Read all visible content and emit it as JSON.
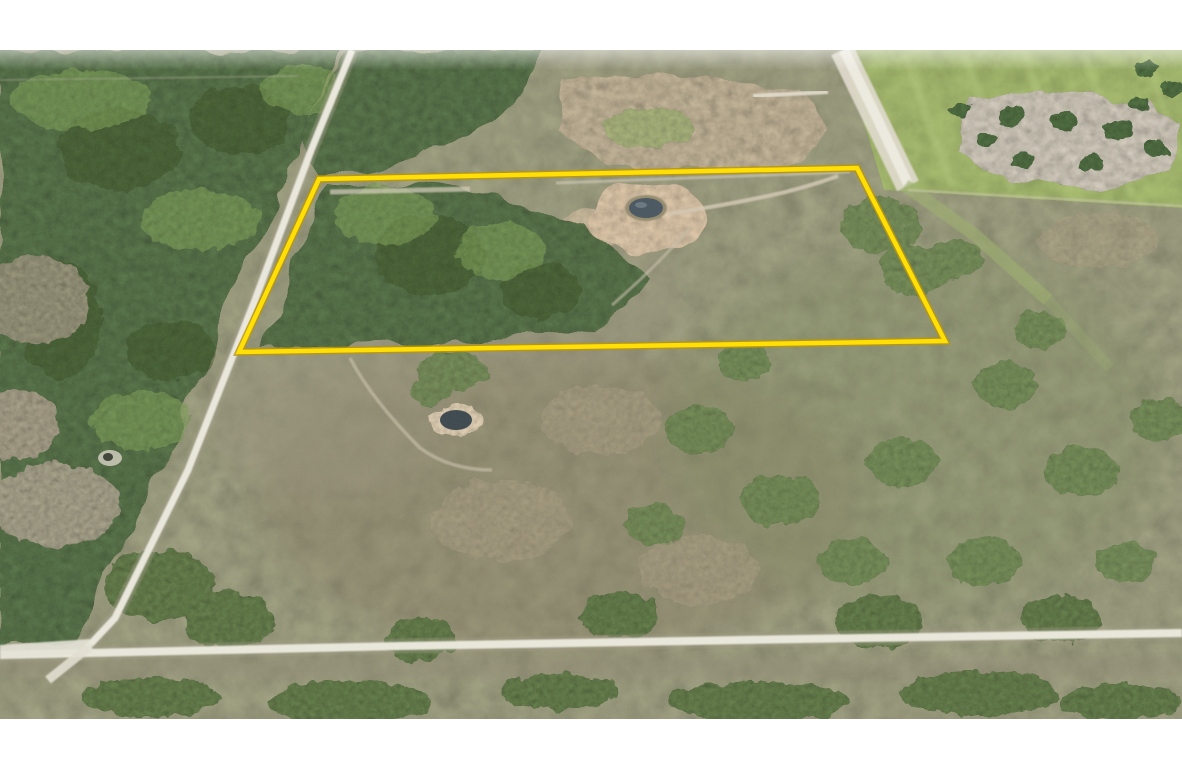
{
  "meta": {
    "type": "aerial-drone-photograph",
    "subject": "vacant rural land parcel highlighted with a yellow boundary overlay",
    "setting": "flat scrubland with dense tree stands, white dirt roads, two small ponds and a green pasture",
    "visible_text": "none"
  },
  "canvas": {
    "width": 1182,
    "height": 772,
    "letterbox_color": "#ffffff",
    "photo_top": 50,
    "photo_height": 669
  },
  "overlay": {
    "parcel_boundary": {
      "shape": "quadrilateral",
      "points": "319,179 857,168 945,341 239,352",
      "color": "#ffdf05",
      "edge_color": "#b8960f",
      "stroke_width": 4.5
    }
  },
  "terrain": {
    "scrub_color": "#8b8c70",
    "forest_color": "#46603a",
    "pasture_color": "#93a75f",
    "cleared_gray_color": "#b5afa2",
    "sand_mound_color": "#a89b82",
    "pond_clearing_color": "#c2ae93",
    "bottom_bush_color": "#51683b"
  },
  "features": {
    "ponds": [
      {
        "name": "pond-inside-parcel",
        "cx": 646,
        "cy": 208,
        "color": "#46545f"
      },
      {
        "name": "pond-south-of-parcel",
        "cx": 456,
        "cy": 420,
        "color": "#39454c"
      }
    ],
    "roads": [
      {
        "name": "diagonal-dirt-road-west",
        "color": "#edeadf"
      },
      {
        "name": "bottom-dirt-road",
        "color": "#eceade"
      },
      {
        "name": "north-south-road-east",
        "color": "#f0ede3"
      },
      {
        "name": "grass-lane-east",
        "color": "#9cb06d"
      }
    ]
  }
}
